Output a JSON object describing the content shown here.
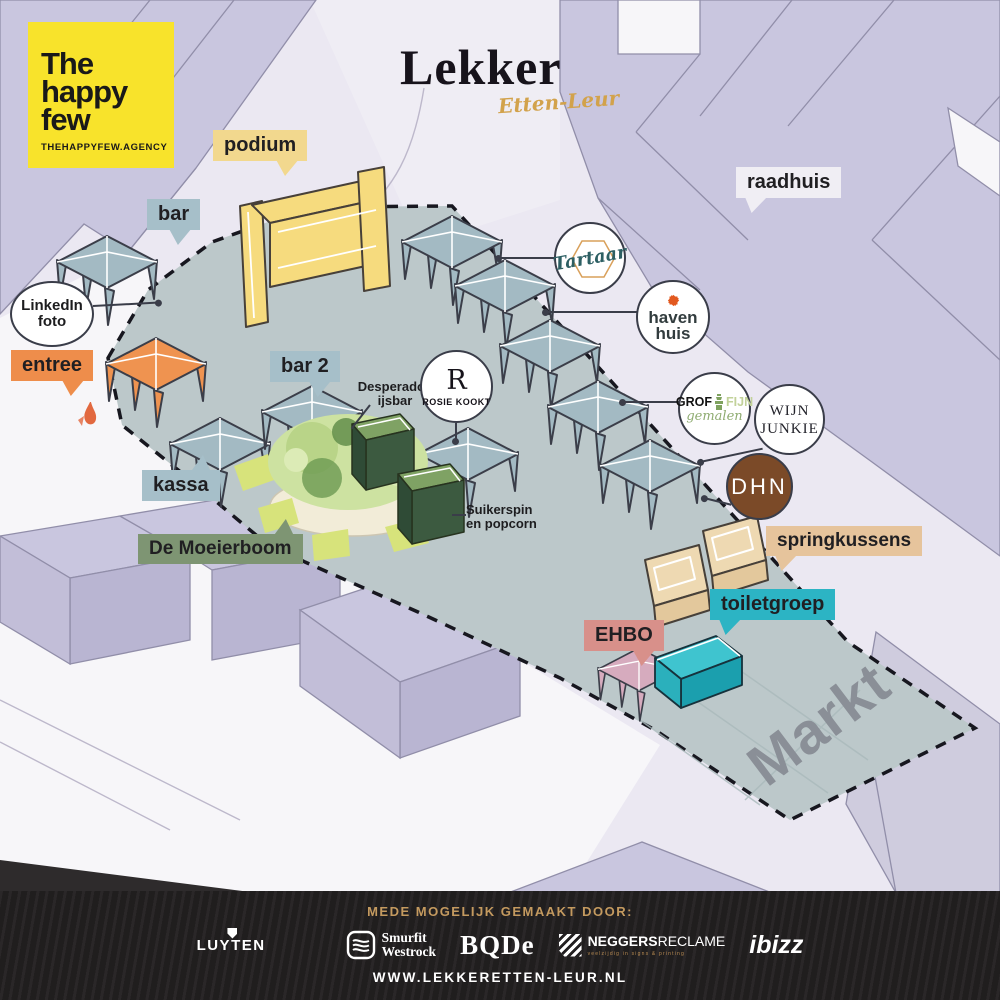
{
  "palette": {
    "background": "#ebe8f2",
    "buildings": "#c9c6df",
    "event_area": "#bcc8ca",
    "tent": "#a3bac3",
    "logo_yellow": "#f8e32b",
    "stage_yellow": "#f6db7e",
    "orange": "#ee8d4b",
    "teal": "#2cb4c4",
    "salmon": "#d8908a",
    "tan": "#e6c49c",
    "sage_green": "#7e9573",
    "dark_green": "#3c5a40",
    "brown": "#7b4a28",
    "gold": "#c49a5f",
    "footer_bg": "#232021"
  },
  "branding": {
    "agency": {
      "line1": "The",
      "line2": "happy",
      "line3": "few",
      "url": "THEHAPPYFEW.AGENCY"
    },
    "event": {
      "title": "Lekker",
      "subtitle": "Etten-Leur"
    }
  },
  "tags": {
    "podium": {
      "label": "podium"
    },
    "bar": {
      "label": "bar"
    },
    "entree": {
      "label": "entree"
    },
    "bar2": {
      "label": "bar 2"
    },
    "kassa": {
      "label": "kassa"
    },
    "moeierboom": {
      "label": "De Moeierboom"
    },
    "raadhuis": {
      "label": "raadhuis"
    },
    "springkussens": {
      "label": "springkussens"
    },
    "toiletgroep": {
      "label": "toiletgroep"
    },
    "ehbo": {
      "label": "EHBO"
    }
  },
  "circles": {
    "linkedin": {
      "line1": "LinkedIn",
      "line2": "foto"
    },
    "tartaar": {
      "name": "Tartaar"
    },
    "havenhuis": {
      "line1": "haven",
      "line2": "huis"
    },
    "rosie": {
      "initial": "R",
      "name": "ROSIE KOOKT"
    },
    "grof": {
      "word1": "GROF",
      "word2": "FIJN",
      "word3": "gemalen"
    },
    "wijn": {
      "line1": "WIJN",
      "line2": "JUNKIE"
    },
    "dhn": {
      "letters": "DHN"
    }
  },
  "notes": {
    "desperados": {
      "line1": "Desperados",
      "line2": "ijsbar"
    },
    "suikerspin": {
      "line1": "Suikerspin",
      "line2": "en popcorn"
    }
  },
  "area_label": "Markt",
  "footer": {
    "heading": "MEDE MOGELIJK GEMAAKT DOOR:",
    "website": "WWW.LEKKERETTEN-LEUR.NL",
    "sponsors": {
      "luyten": "LUYTEN",
      "ak": "AK",
      "smurfit_line1": "Smurfit",
      "smurfit_line2": "Westrock",
      "bode": "BQDe",
      "neggers_bold": "NEGGERS",
      "neggers_light": "RECLAME",
      "neggers_sub": "veelzijdig in signs & printing",
      "ibizz": "ibizz"
    }
  }
}
